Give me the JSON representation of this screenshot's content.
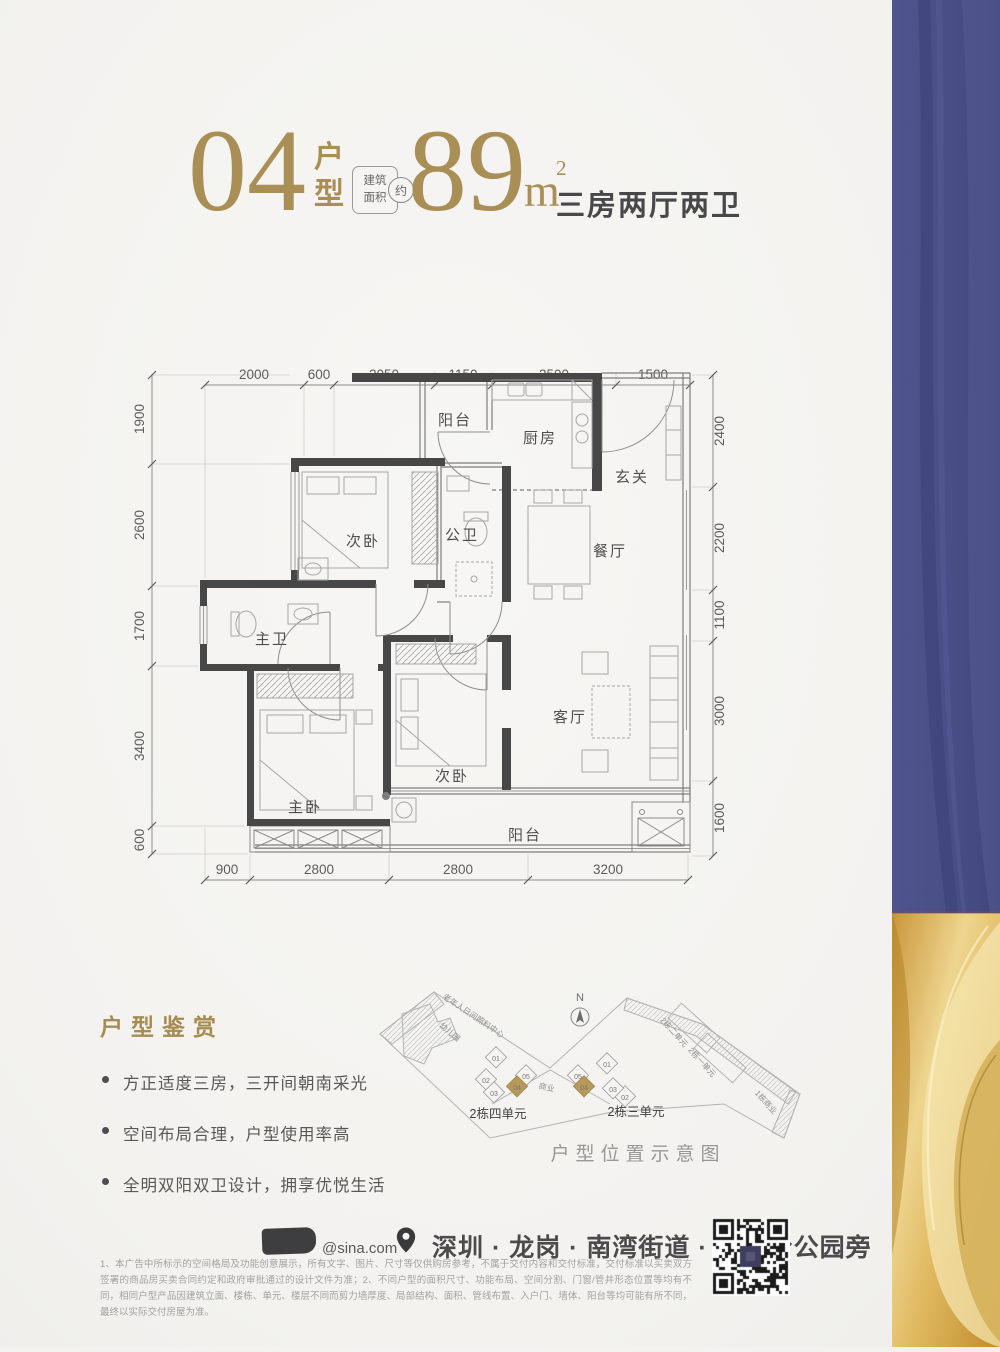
{
  "header": {
    "unit_no": "04",
    "unit_type_label_1": "户",
    "unit_type_label_2": "型",
    "badge_top": "建筑",
    "badge_bottom": "面积",
    "badge_approx": "约",
    "area_value": "89",
    "area_unit": "m",
    "area_exp": "2",
    "rooms_desc": "三房两厅两卫"
  },
  "plan": {
    "rooms": {
      "balcony_top": "阳台",
      "kitchen": "厨房",
      "entry": "玄关",
      "bedroom_top": "次卧",
      "bath_public": "公卫",
      "dining": "餐厅",
      "bath_master": "主卫",
      "bedroom_master": "主卧",
      "bedroom_bottom": "次卧",
      "living": "客厅",
      "balcony_bottom": "阳台"
    },
    "dims": {
      "top": [
        "2000",
        "600",
        "2050",
        "1150",
        "2500",
        "1500"
      ],
      "left": [
        "1900",
        "2600",
        "1700",
        "3400",
        "600"
      ],
      "right": [
        "2400",
        "2200",
        "1100",
        "3000",
        "1600"
      ],
      "bottom": [
        "900",
        "2800",
        "2800",
        "3200"
      ]
    }
  },
  "features": {
    "title": "户型鉴赏",
    "items": [
      "方正适度三房，三开间朝南采光",
      "空间布局合理，户型使用率高",
      "全明双阳双卫设计，拥享优悦生活"
    ]
  },
  "siteplan": {
    "north": "N",
    "caption": "户型位置示意图",
    "kindergarten": "幼儿园",
    "care_center": "老年人日间照料中心",
    "commerce": "商业",
    "cluster_left_label": "2栋四单元",
    "cluster_right_label": "2栋三单元",
    "bldg_unit2": "2栋二单元",
    "bldg_unit1": "2栋一单元",
    "bldg_retail": "1栋商业",
    "units": [
      "01",
      "02",
      "03",
      "04",
      "05"
    ]
  },
  "footer": {
    "handle": "@sina.com",
    "address": "深圳 · 龙岗 · 南湾街道 · 石芽岭公园旁",
    "disclaimer": "1、本广告中所标示的空间格局及功能创意展示，所有文字、图片、尺寸等仅供购房参考，不属于交付内容和交付标准，交付标准以买卖双方签署的商品房买卖合同约定和政府审批通过的设计文件为准；2、不同户型的面积尺寸、功能布局、空间分割、门窗/管井形态位置等均有不同，相同户型产品因建筑立面、楼栋、单元、楼层不同而剪力墙厚度、局部结构、面积、管线布置、入户门、墙体、阳台等均可能有所不同，最终以实际交付房屋为准。"
  },
  "colors": {
    "gold": "#a98e55",
    "dark": "#48484a",
    "wall": "#474747",
    "blue_band": "#4d5189",
    "gold_band": "#d8aa4b"
  }
}
